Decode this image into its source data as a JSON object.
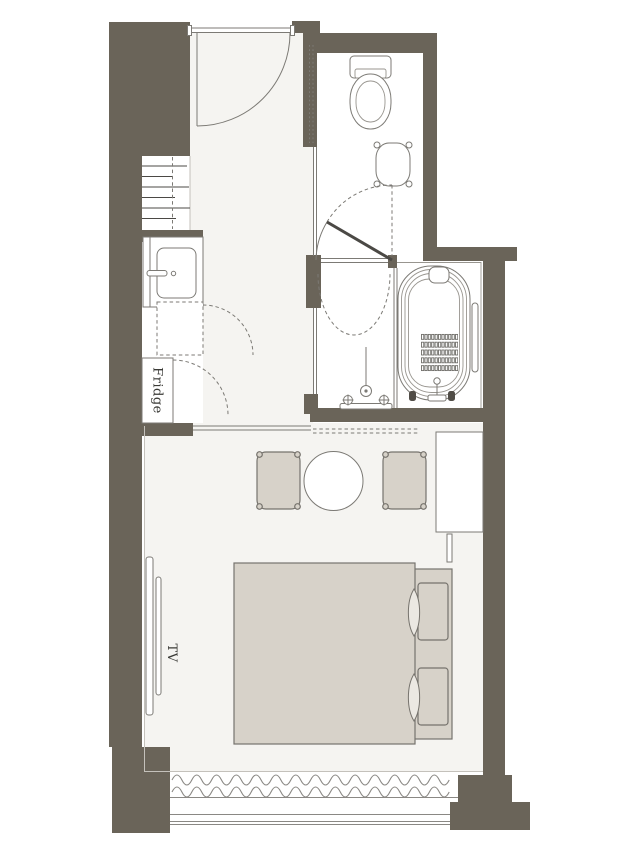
{
  "labels": {
    "fridge": "Fridge",
    "tv": "TV"
  },
  "colors": {
    "bg": "#ffffff",
    "wall": "#6a6459",
    "floor": "#f5f4f1",
    "furniture": "#d7d2c9",
    "pillow": "#ebe8e2",
    "outline": "#7c7a75",
    "outline_dark": "#4b4945",
    "window_line": "#8a8884"
  }
}
